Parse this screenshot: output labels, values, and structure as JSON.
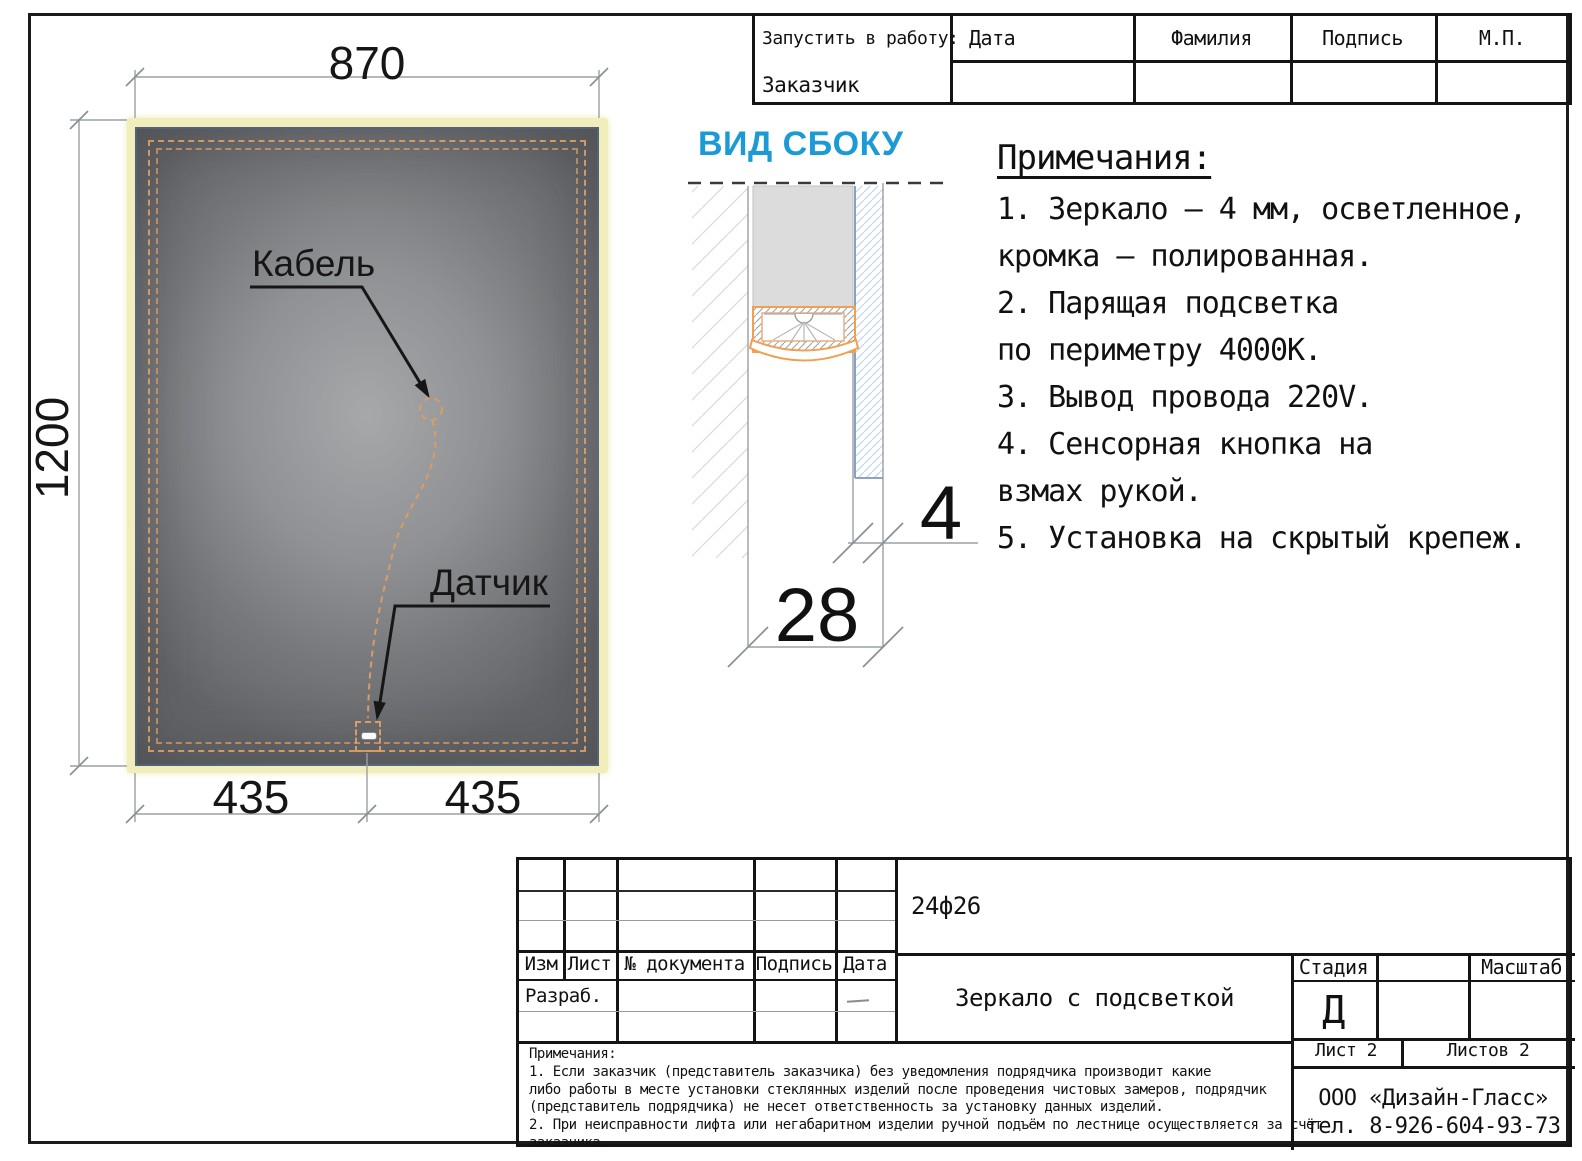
{
  "colors": {
    "accent_blue": "#1c9ad6",
    "led_orange": "#f0a050",
    "glow_yellow": "#f1eebc"
  },
  "top_stamp": {
    "launch_label": "Запустить в работу:",
    "customer_label": "Заказчик",
    "columns": [
      "Дата",
      "Фамилия",
      "Подпись",
      "М.П."
    ]
  },
  "front_view": {
    "width_dim": "870",
    "height_dim": "1200",
    "bottom_left_dim": "435",
    "bottom_right_dim": "435",
    "cable_label": "Кабель",
    "sensor_label": "Датчик"
  },
  "side_view": {
    "title": "ВИД СБОКУ",
    "glass_thickness_dim": "4",
    "depth_dim": "28"
  },
  "notes": {
    "heading": "Примечания:",
    "lines": [
      "1. Зеркало – 4 мм, осветленное,",
      "кромка – полированная.",
      "2. Парящая подсветка",
      "по периметру 4000К.",
      "3. Вывод провода 220V.",
      "4. Сенсорная кнопка на",
      "взмах рукой.",
      "5. Установка на скрытый крепеж."
    ]
  },
  "title_block": {
    "doc_code": "24ф26",
    "product_name": "Зеркало с подсветкой",
    "table_headers": [
      "Изм",
      "Лист",
      "№ документа",
      "Подпись",
      "Дата"
    ],
    "developer_label": "Разраб.",
    "stage_label": "Стадия",
    "stage_value": "Д",
    "scale_label": "Масштаб",
    "sheet_info": "Лист 2",
    "sheets_info": "Листов 2",
    "company_name": "ООО «Дизайн-Гласс»",
    "company_phone": "тел. 8-926-604-93-73",
    "footnotes": [
      "Примечания:",
      "1. Если заказчик (представитель заказчика) без уведомления подрядчика производит какие",
      "либо работы в месте установки стеклянных изделий после проведения чистовых замеров, подрядчик",
      "(представитель подрядчика) не несет ответственность за установку данных изделий.",
      "2. При неисправности лифта или негабаритном изделии ручной подъём по лестнице осуществляется за счёт",
      "заказчика."
    ]
  }
}
